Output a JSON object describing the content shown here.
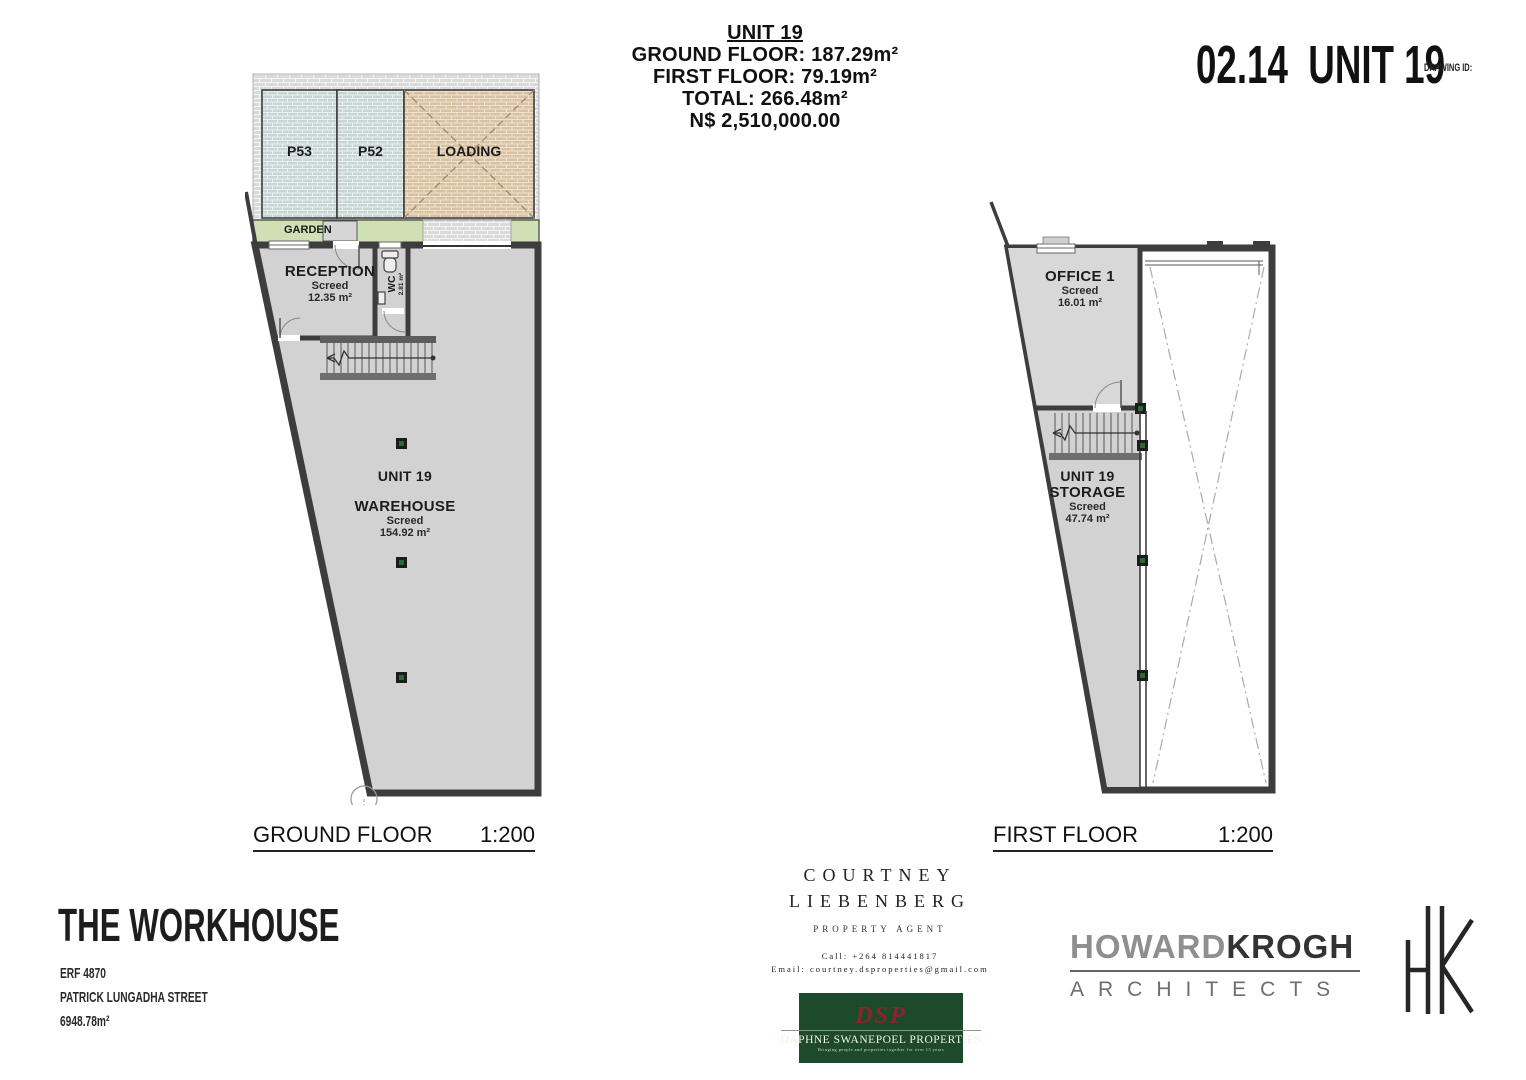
{
  "header": {
    "unit_title": "UNIT 19",
    "ground_floor": "GROUND FLOOR: 187.29m²",
    "first_floor": "FIRST FLOOR: 79.19m²",
    "total": "TOTAL: 266.48m²",
    "price": "N$ 2,510,000.00"
  },
  "title_block": {
    "drawing_number": "02.14",
    "unit": "UNIT 19",
    "drawing_id_label": "DRAWING ID:"
  },
  "ground_plan": {
    "parking_p53": "P53",
    "parking_p52": "P52",
    "loading_label": "LOADING",
    "garden_label": "GARDEN",
    "reception": {
      "name": "RECEPTION",
      "finish": "Screed",
      "area": "12.35 m²"
    },
    "wc": {
      "name": "WC",
      "area": "2.81 m²"
    },
    "unit_label": "UNIT 19",
    "warehouse": {
      "name": "WAREHOUSE",
      "finish": "Screed",
      "area": "154.92 m²"
    },
    "caption": "GROUND FLOOR",
    "scale": "1:200"
  },
  "first_plan": {
    "office": {
      "name": "OFFICE 1",
      "finish": "Screed",
      "area": "16.01 m²"
    },
    "storage": {
      "line1": "UNIT 19",
      "line2": "STORAGE",
      "finish": "Screed",
      "area": "47.74 m²"
    },
    "caption": "FIRST FLOOR",
    "scale": "1:200"
  },
  "project": {
    "name": "THE WORKHOUSE",
    "erf": "ERF 4870",
    "street": "PATRICK LUNGADHA STREET",
    "site_area": "6948.78m²"
  },
  "agent": {
    "name_line1": "COURTNEY",
    "name_line2": "LIEBENBERG",
    "role": "PROPERTY AGENT",
    "call": "Call: +264 814441817",
    "email": "Email: courtney.dsproperties@gmail.com"
  },
  "dsp": {
    "monogram": "DSP",
    "name": "DAPHNE SWANEPOEL PROPERTIES",
    "tagline": "Bringing people and properties together for over 15 years"
  },
  "architects": {
    "name_part1": "HOWARD",
    "name_part2": "KROGH",
    "subtitle": "ARCHITECTS"
  },
  "colors": {
    "wall": "#3d3d3d",
    "floor": "#d2d2d2",
    "parking": "#c9d7d5",
    "loading": "#d9c2a3",
    "garden": "#cfe0b4",
    "paving": "#dcdcdc",
    "column_green": "#2d6a33",
    "dsp_green": "#1d4a2a",
    "dsp_red": "#8d2330",
    "howard_gray": "#8f8f8f",
    "krogh_dark": "#333333"
  }
}
